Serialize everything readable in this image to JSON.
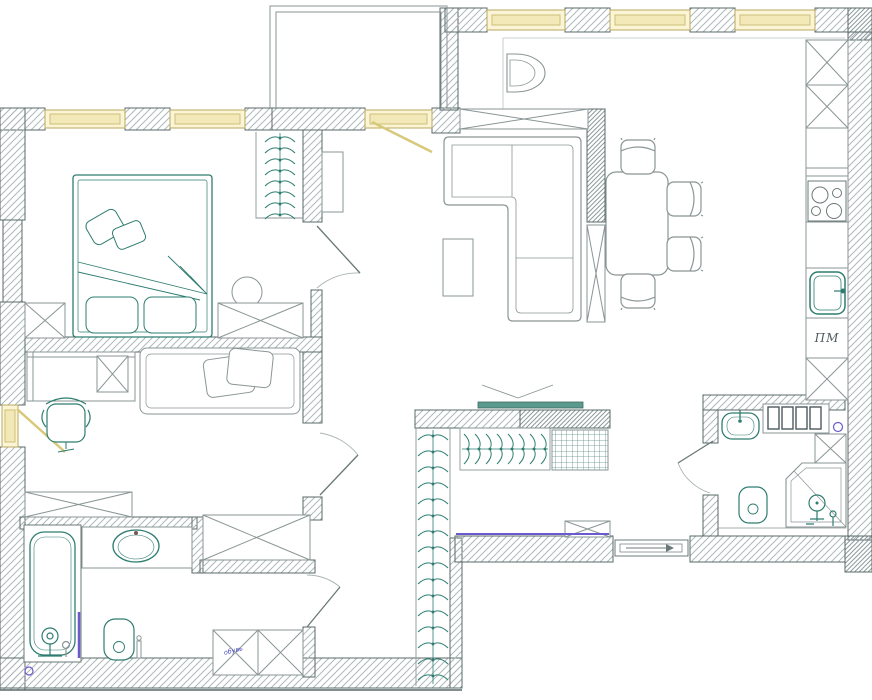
{
  "drawing": {
    "type": "apartment floor plan (top view, architectural drawing)",
    "labels": {
      "dishwasher_abbr": "ПМ",
      "entry_cabinet_note": "обувь"
    },
    "colors": {
      "background": "#ffffff",
      "wall_outline": "#5a6868",
      "wall_hatch": "#adb9b9",
      "wall_hatch_dense": "#8d9b9b",
      "window_fill": "#fbf4d5",
      "window_inner": "#f3e9b8",
      "window_frame": "#b9a95f",
      "sash_yellow": "#d8c87a",
      "fixture_teal": "#2e7d70",
      "furniture_gray": "#8a9595",
      "accent_purple": "#6a5acd",
      "note_blue": "#4d4dc0",
      "tv_fill": "#5d9a8e",
      "shelf_grid": "#5d8f86"
    },
    "fixtures": [
      "double-bed",
      "pillows",
      "blanket",
      "bedside-cabinet",
      "pouf",
      "open-wardrobe-hanger-rail",
      "dresser",
      "desk",
      "desk-cabinet",
      "office-chair",
      "daybed",
      "wardrobe-cabinet",
      "corner-sofa",
      "coffee-table",
      "tv-stand-cabinet",
      "armchair",
      "dining-table",
      "dining-chair",
      "kitchen-cabinet",
      "hob-4-burners",
      "kitchen-sink",
      "dishwasher-bay",
      "bathtub",
      "bath-mixer",
      "vanity-counter",
      "vanity-sink",
      "toilet",
      "toilet-brush",
      "heated-towel-rail",
      "washbasin",
      "radiator",
      "corner-shower",
      "shower-head",
      "entry-wardrobe-rail",
      "shelf-unit",
      "shoe-cabinet",
      "wall-tv",
      "entrance-door",
      "interior-door",
      "window",
      "balcony"
    ]
  }
}
